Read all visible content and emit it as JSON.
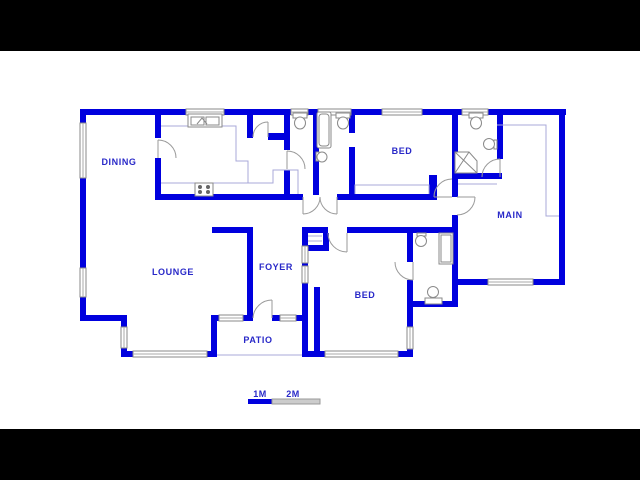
{
  "image": {
    "type": "floor-plan-drawing"
  },
  "rooms": {
    "dining": "DINING",
    "lounge": "LOUNGE",
    "foyer": "FOYER",
    "patio": "PATIO",
    "bed_top": "BED",
    "bed_bottom": "BED",
    "main": "MAIN"
  },
  "scale_bar": {
    "label_1m": "1M",
    "label_2m": "2M"
  },
  "colors": {
    "wall": "#0000DE",
    "label_text": "#2828C8",
    "counter_line": "#A9A9D8",
    "fixture_outline": "#8A8A8A",
    "scale_bar_filled": "#0000DE",
    "scale_bar_empty": "#CCCCCC",
    "letterbox": "#000000",
    "background": "#FFFFFF"
  }
}
